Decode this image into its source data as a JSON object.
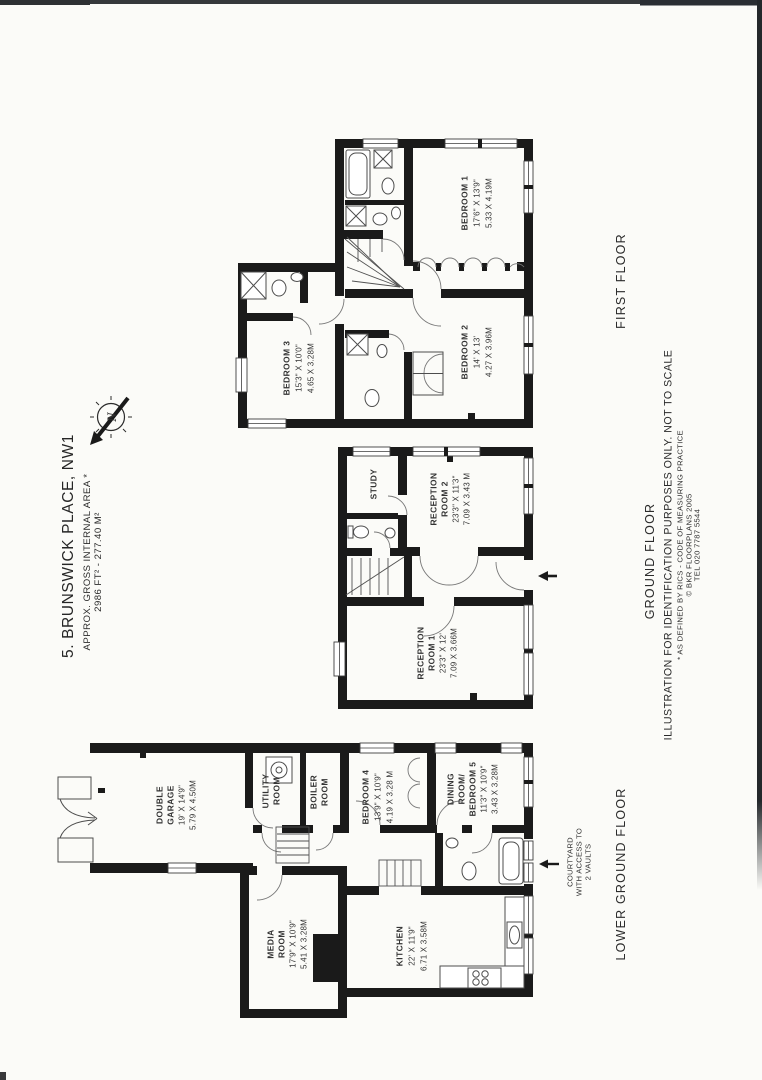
{
  "meta": {
    "title": "5. BRUNSWICK PLACE, NW1",
    "subtitle": "APPROX. GROSS INTERNAL AREA *",
    "area": "2986 FT² - 277.40 M²"
  },
  "compass": {
    "letter": "N"
  },
  "floors": {
    "first": {
      "label": "FIRST FLOOR",
      "bedroom1": {
        "name": "BEDROOM 1",
        "imperial": "17'6\" X 13'9\"",
        "metric": "5.33 X 4.19M"
      },
      "bedroom2": {
        "name": "BEDROOM 2",
        "imperial": "14' X 13'",
        "metric": "4.27 X 3.96M"
      },
      "bedroom3": {
        "name": "BEDROOM 3",
        "imperial": "15'3\" X 10'0\"",
        "metric": "4.65 X 3.28M"
      }
    },
    "ground": {
      "label": "GROUND FLOOR",
      "study": {
        "name": "STUDY"
      },
      "reception2": {
        "l1": "RECEPTION",
        "l2": "ROOM 2",
        "imperial": "23'3\" X 11'3\"",
        "metric": "7.09 X 3.43 M"
      },
      "reception1": {
        "l1": "RECEPTION",
        "l2": "ROOM 1",
        "imperial": "23'3\" X 12'",
        "metric": "7.09 X 3.66M"
      }
    },
    "lower": {
      "label": "LOWER GROUND FLOOR",
      "garage": {
        "l1": "DOUBLE",
        "l2": "GARAGE",
        "imperial": "19' X 14'9\"",
        "metric": "5.79 X 4.50M"
      },
      "utility": {
        "l1": "UTILITY",
        "l2": "ROOM"
      },
      "boiler": {
        "l1": "BOILER",
        "l2": "ROOM"
      },
      "bedroom4": {
        "name": "BEDROOM 4",
        "imperial": "13'9\" X 10'9\"",
        "metric": "4.19 X 3.28 M"
      },
      "dining": {
        "l1": "DINING",
        "l2": "ROOM/",
        "l3": "BEDROOM 5",
        "imperial": "11'3\" X 10'9\"",
        "metric": "3.43 X 3.28M"
      },
      "media": {
        "l1": "MEDIA",
        "l2": "ROOM",
        "imperial": "17'9\" X 10'9\"",
        "metric": "5.41 X 3.28M"
      },
      "kitchen": {
        "name": "KITCHEN",
        "imperial": "22' X 11'9\"",
        "metric": "6.71 X 3.58M"
      },
      "courtyard": {
        "l1": "COURTYARD",
        "l2": "WITH ACCESS TO",
        "l3": "2 VAULTS"
      }
    }
  },
  "footer": {
    "disclaimer": "ILLUSTRATION FOR IDENTIFICATION PURPOSES ONLY. NOT TO SCALE",
    "note": "* AS DEFINED BY RICS - CODE OF MEASURING PRACTICE",
    "copyright": "© BKR FLOORPLANS 2005",
    "tel": "TEL 020 7787 5544"
  },
  "colors": {
    "paper": "#fbfbf8",
    "wall": "#1a1a1a",
    "ink": "#2f2f2f"
  }
}
